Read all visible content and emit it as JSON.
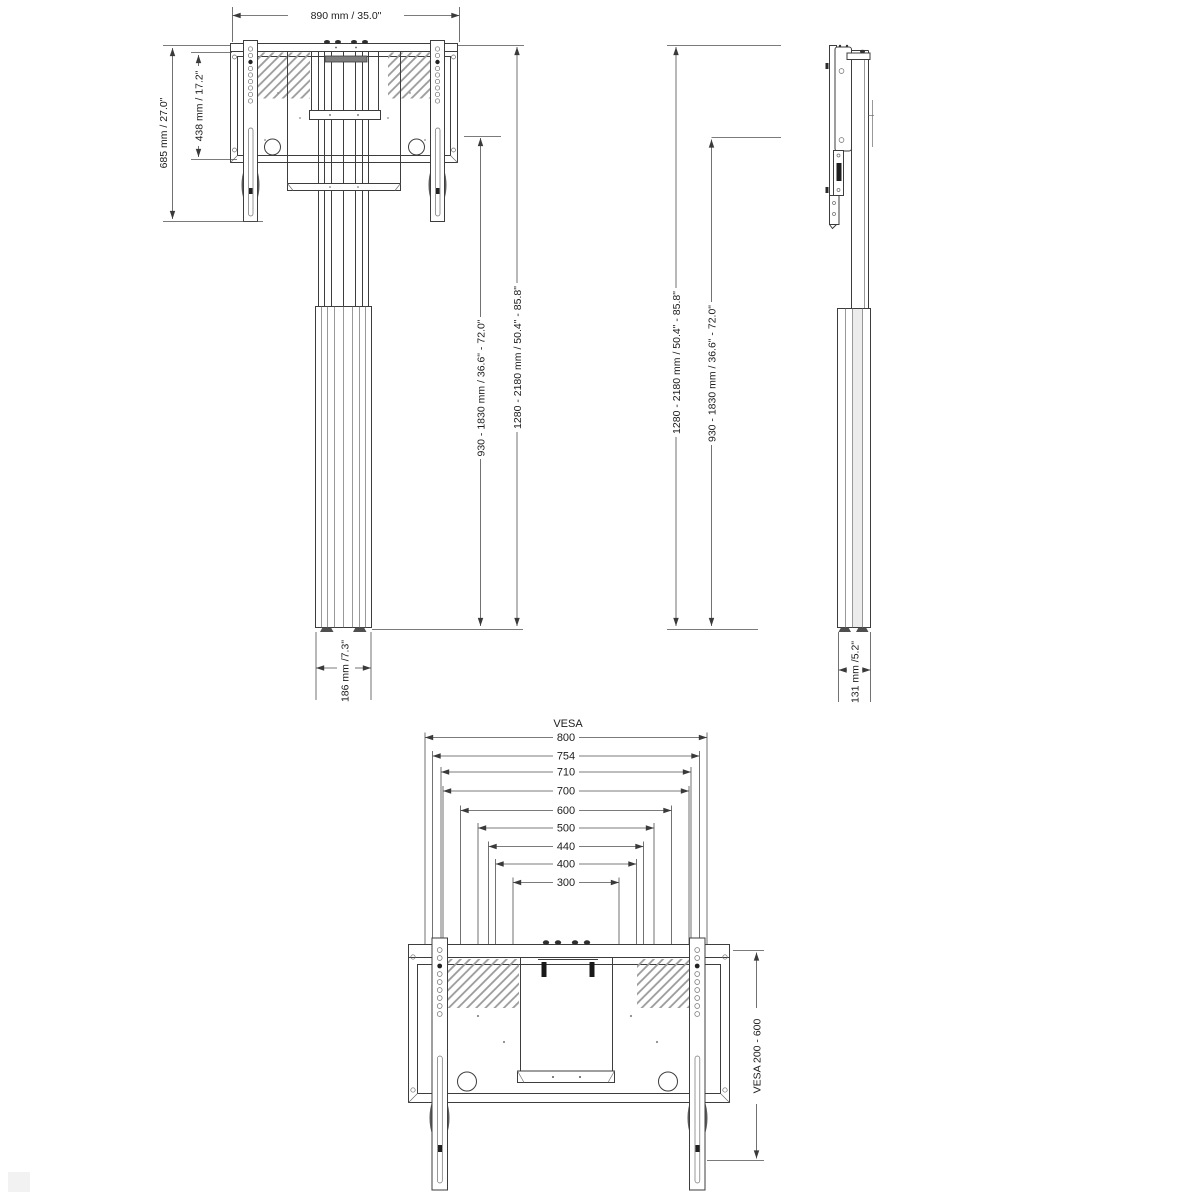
{
  "drawing": {
    "front_view": {
      "width": "890 mm / 35.0\"",
      "bracket_height": "685 mm / 27.0\"",
      "plate_height": "438 mm / 17.2\"",
      "column_height": "930 - 1830 mm / 36.6\" - 72.0\"",
      "total_height": "1280 - 2180 mm / 50.4\" - 85.8\"",
      "base_width": "186 mm /7.3\""
    },
    "side_view": {
      "total_height": "1280 - 2180 mm / 50.4\" - 85.8\"",
      "column_height": "930 - 1830 mm / 36.6\" - 72.0\"",
      "base_depth": "131 mm /5.2\""
    },
    "rear_view": {
      "vesa_title": "VESA",
      "vesa_widths": [
        "800",
        "754",
        "710",
        "700",
        "600",
        "500",
        "440",
        "400",
        "300"
      ],
      "vesa_height_range": "VESA 200 - 600"
    }
  }
}
